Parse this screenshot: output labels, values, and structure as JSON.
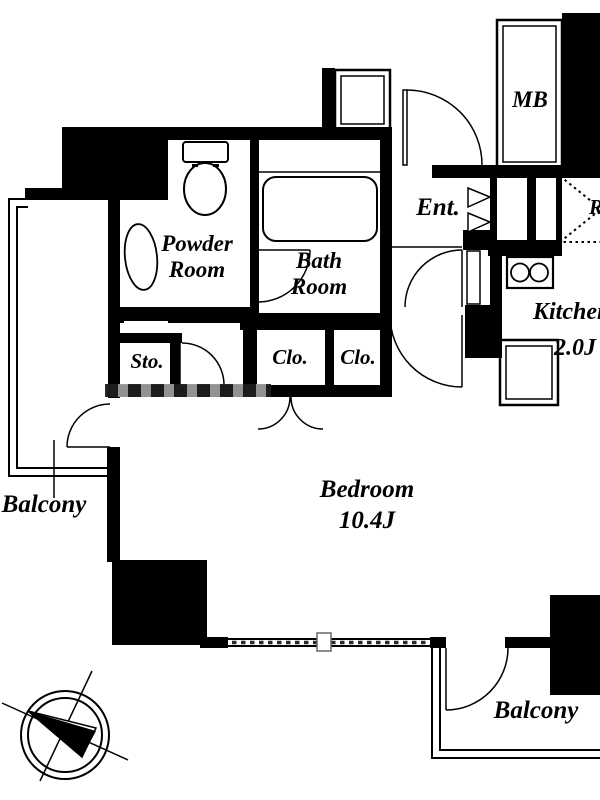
{
  "floor_plan": {
    "labels": {
      "powder_room": {
        "line1": "Powder",
        "line2": "Room"
      },
      "bath_room": {
        "line1": "Bath",
        "line2": "Room"
      },
      "storage": "Sto.",
      "closet_left": "Clo.",
      "closet_right": "Clo.",
      "entrance": "Ent.",
      "meter_box": "MB",
      "refrigerator": "R",
      "kitchen_name": "Kitchen",
      "kitchen_size": "2.0J",
      "bedroom_name": "Bedroom",
      "bedroom_size": "10.4J",
      "balcony_left": "Balcony",
      "balcony_bottom": "Balcony"
    },
    "icons": {
      "compass": "compass-north-icon",
      "toilet": "toilet-icon",
      "bathtub": "bathtub-icon",
      "vanity_sink": "sink-icon",
      "stove": "two-burner-stove-icon",
      "kitchen_sink": "kitchen-sink-icon"
    },
    "colors": {
      "wall": "#000000",
      "background": "#ffffff",
      "line": "#000000",
      "watermark_gray": "#9a9a9a"
    }
  }
}
